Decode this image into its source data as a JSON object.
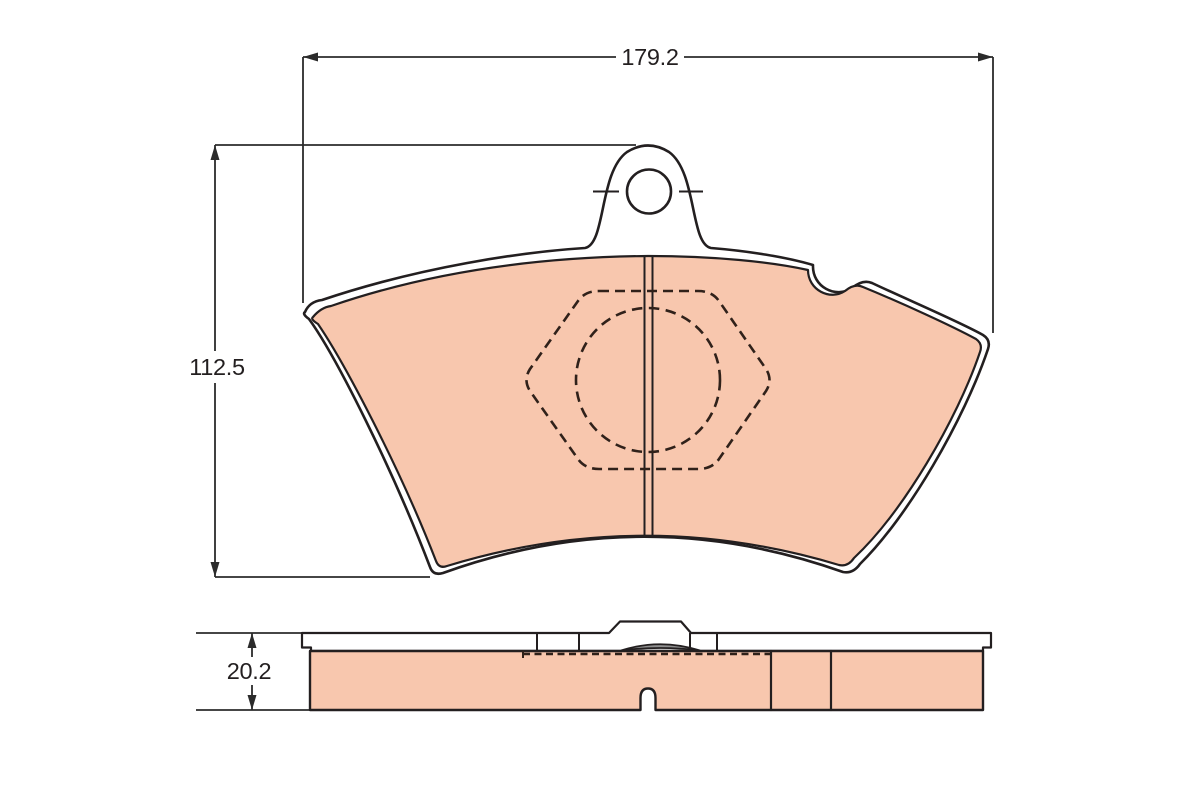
{
  "page": {
    "background": "#FFFFFF"
  },
  "drawing": {
    "subject": "brake-pad-technical-drawing",
    "dimensions": {
      "width": "179.2",
      "height": "112.5",
      "thickness": "20.2"
    },
    "colors": {
      "pad_fill": "#F8C7AE",
      "line": "#231F20",
      "dim_line": "#2B2B2B",
      "dashed_line": "#30211A",
      "section_gray": "#8F8F8F",
      "white": "#FFFFFF"
    }
  }
}
